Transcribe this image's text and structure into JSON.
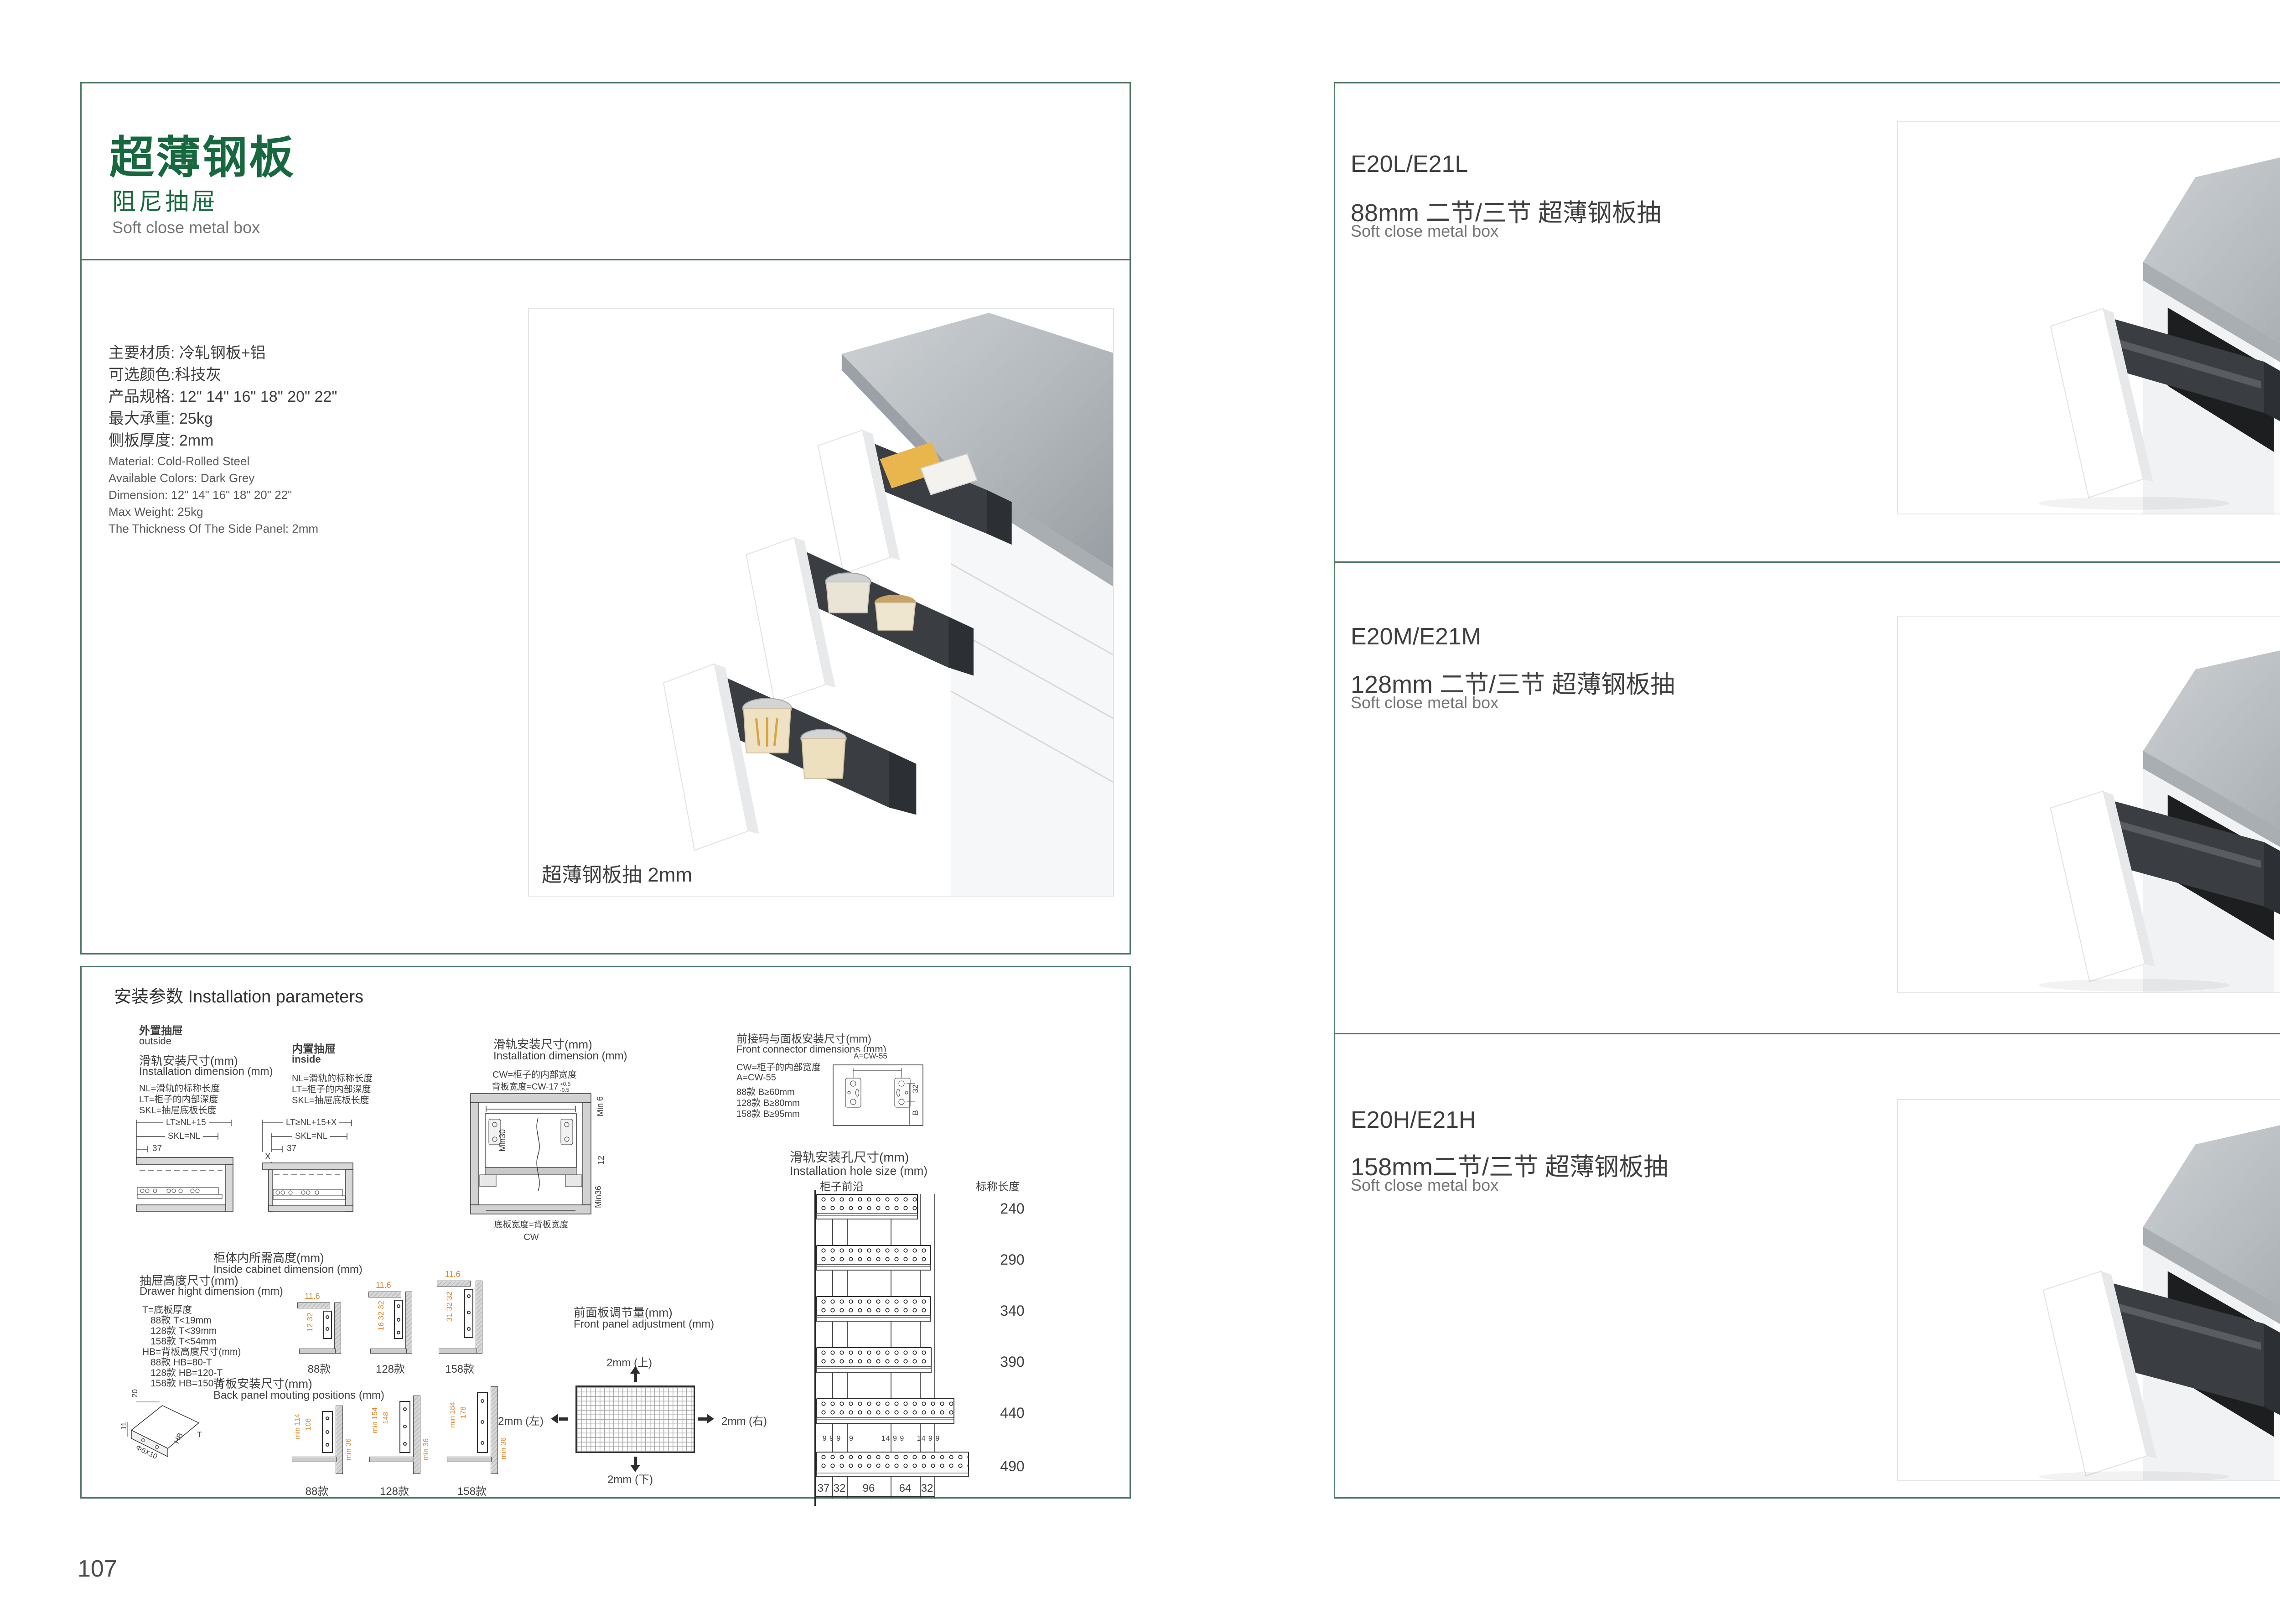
{
  "colors": {
    "accent_green": "#17683e",
    "border_green": "#4f7a66",
    "orange": "#d9882f",
    "text_dark": "#3f3f3f",
    "text_grey": "#757575"
  },
  "left": {
    "page_number": "107",
    "header": {
      "title_cn": "超薄钢板",
      "subtitle_cn": "阻尼抽屉",
      "subtitle_en": "Soft close metal box"
    },
    "specs_cn": [
      "主要材质: 冷轧钢板+铝",
      "可选颜色:科技灰",
      "产品规格: 12\" 14\" 16\" 18\" 20\" 22\"",
      "最大承重: 25kg",
      "侧板厚度: 2mm"
    ],
    "specs_en": [
      "Material: Cold-Rolled Steel",
      "Available Colors: Dark Grey",
      "Dimension: 12\" 14\" 16\" 18\" 20\" 22\"",
      "Max Weight: 25kg",
      "The Thickness Of The Side Panel: 2mm"
    ],
    "photo_caption": "超薄钢板抽 2mm",
    "install": {
      "section_title": "安装参数 Installation parameters",
      "outside": {
        "name_cn": "外置抽屉",
        "name_en": "outside",
        "dim_cn": "滑轨安装尺寸(mm)",
        "dim_en": "Installation dimension (mm)",
        "legend_1": "NL=滑轨的标称长度",
        "legend_2": "LT=柜子的内部深度",
        "legend_3": "SKL=抽屉底板长度",
        "dim_top": "LT≥NL+15",
        "dim_mid": "SKL=NL",
        "dim_front": "37"
      },
      "inside": {
        "name_cn": "内置抽屉",
        "name_en": "inside",
        "legend_1": "NL=滑轨的标称长度",
        "legend_2": "LT=柜子的内部深度",
        "legend_3": "SKL=抽屉底板长度",
        "dim_top": "LT≥NL+15+X",
        "dim_mid": "SKL=NL",
        "dim_front": "37",
        "dim_x": "X"
      },
      "width_diagram": {
        "title_cn": "滑轨安装尺寸(mm)",
        "title_en": "Installation dimension (mm)",
        "legend": "CW=柜子的内部宽度",
        "back_width": "背板宽度=CW-17",
        "tol_plus": "+0.5",
        "tol_minus": "-0.5",
        "min6": "Min 6",
        "min30": "Min30",
        "d12": "12",
        "min36": "Min36",
        "bottom_width": "底板宽度=背板宽度",
        "cw": "CW"
      },
      "front_connector": {
        "title_cn": "前接码与面板安装尺寸(mm)",
        "title_en": "Front connector  dimensions (mm)",
        "legend_cw": "CW=柜子的内部宽度",
        "legend_a": "A=CW-55",
        "legend_88": "88款   B≥60mm",
        "legend_128": "128款  B≥80mm",
        "legend_158": "158款  B≥95mm",
        "dim_a": "A=CW-55",
        "dim_32": "32",
        "dim_b": "B"
      },
      "hole_size": {
        "title_cn": "滑轨安装孔尺寸(mm)",
        "title_en": "Installation hole size (mm)",
        "front_edge": "柜子前沿",
        "length_header": "标称长度",
        "lengths": [
          "240",
          "290",
          "340",
          "390",
          "440",
          "490"
        ],
        "top_dims": [
          "9 9 9",
          "9",
          "14 9 9",
          "14 9 9"
        ],
        "bottom_dims": [
          "37",
          "32",
          "96",
          "64",
          "32"
        ]
      },
      "drawer_height": {
        "title_cn": "抽屉高度尺寸(mm)",
        "title_en": "Drawer hight dimension (mm)",
        "line_t": "T=底板厚度",
        "line_t88": "88款   T<19mm",
        "line_t128": "128款  T<39mm",
        "line_t158": "158款  T<54mm",
        "line_hb": "HB=背板高度尺寸(mm)",
        "line_hb88": "88款   HB=80-T",
        "line_hb128": "128款 HB=120-T",
        "line_hb158": "158款 HB=150-T",
        "iso_20": "20",
        "iso_11": "11",
        "iso_hole": "Φ6X10",
        "iso_hb": "HB",
        "iso_t": "T"
      },
      "inside_cabinet": {
        "title_cn": "柜体内所需高度(mm)",
        "title_en": "Inside cabinet dimension (mm)",
        "v88_top": "11.6",
        "v88_side": "12 32",
        "v88_label": "88款",
        "v128_top": "11.6",
        "v128_side": "16 32 32",
        "v128_label": "128款",
        "v158_top": "11.6",
        "v158_side": "31 32 32",
        "v158_label": "158款"
      },
      "back_panel": {
        "title_cn": "背板安装尺寸(mm)",
        "title_en": "Back panel mouting positions (mm)",
        "v88_outer": "min 114",
        "v88_inner": "108",
        "v88_right": "min 36",
        "v88_label": "88款",
        "v128_outer": "min 154",
        "v128_inner": "148",
        "v128_right": "min 36",
        "v128_label": "128款",
        "v158_outer": "min 184",
        "v158_inner": "178",
        "v158_right": "min 36",
        "v158_label": "158款"
      },
      "front_adjust": {
        "title_cn": "前面板调节量(mm)",
        "title_en": "Front panel adjustment (mm)",
        "up": "2mm (上)",
        "down": "2mm (下)",
        "left": "2mm (左)",
        "right": "2mm (右)"
      }
    }
  },
  "right": {
    "page_number": "108",
    "sections": [
      {
        "code": "E20L/E21L",
        "title": "88mm 二节/三节 超薄钢板抽",
        "sub": "Soft close metal box"
      },
      {
        "code": "E20M/E21M",
        "title": "128mm 二节/三节 超薄钢板抽",
        "sub": "Soft close metal box"
      },
      {
        "code": "E20H/E21H",
        "title": "158mm二节/三节 超薄钢板抽",
        "sub": "Soft close metal box"
      }
    ]
  }
}
